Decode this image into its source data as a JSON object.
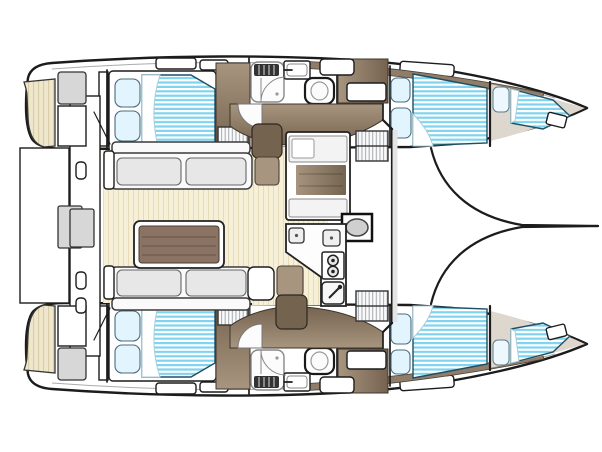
{
  "meta": {
    "description": "Top-down interior floor plan of a sailing catamaran: two hulls with pointed bows to the right, aft platform to the left, central saloon with dining table and galley, four double cabins, two forepeak berths and two bathrooms",
    "orientation": "bows-right"
  },
  "colors": {
    "outline": "#1c1c1c",
    "hull_fill": "#ffffff",
    "teak": "#efe7cb",
    "teak_stripe": "#d9cda8",
    "floor": "#f7f0d8",
    "floor_stripe": "#e6dcba",
    "wood": "#8f7d6a",
    "wood_dark": "#74634f",
    "wood_light": "#a8957f",
    "table": "#8b7363",
    "bed_stripe": "#7fd3ef",
    "pillow": "#e2f4fd",
    "upholstery": "#fafafa",
    "cushion": "#e7e7e7",
    "fixture_gray": "#d7d7d7",
    "hatch": "#fafafa",
    "hatch_line": "#9aa2a8",
    "shade": "#ded7cd",
    "windshield_shade": "#e4e4e4"
  },
  "legend": {
    "double_beds": 4,
    "forepeak_berths": 2,
    "pillows": 10,
    "toilets": 2,
    "showers": 2,
    "bathroom_sinks": 2,
    "galley_burners": 2,
    "galley_sinks": 3,
    "settees": 2,
    "dining_tables": 1,
    "regions": [
      "stern-platform",
      "saloon",
      "galley",
      "hull-port",
      "hull-starboard",
      "foredeck"
    ]
  }
}
